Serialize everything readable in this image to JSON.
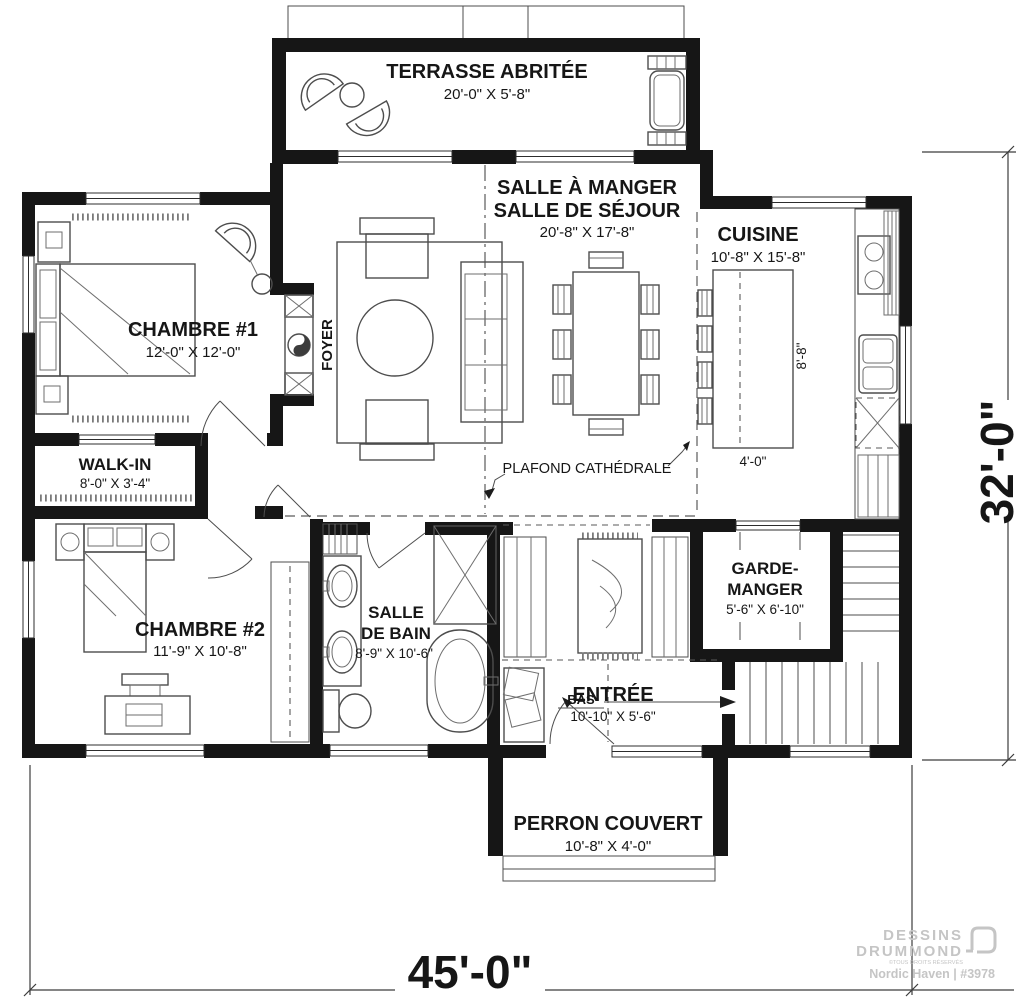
{
  "colors": {
    "wall": "#161616",
    "line": "#4d4d4d",
    "watermark": "#c5c5c5",
    "background": "#ffffff"
  },
  "rooms": {
    "terrasse": {
      "label": "TERRASSE ABRITÉE",
      "dims": "20'-0\" X 5'-8\""
    },
    "sejour": {
      "label1": "SALLE À MANGER",
      "label2": "SALLE DE SÉJOUR",
      "dims": "20'-8\" X 17'-8\""
    },
    "cuisine": {
      "label": "CUISINE",
      "dims": "10'-8\" X 15'-8\""
    },
    "chambre1": {
      "label": "CHAMBRE #1",
      "dims": "12'-0\" X 12'-0\""
    },
    "walkin": {
      "label": "WALK-IN",
      "dims": "8'-0\" X 3'-4\""
    },
    "chambre2": {
      "label": "CHAMBRE #2",
      "dims": "11'-9\" X 10'-8\""
    },
    "bain": {
      "label1": "SALLE",
      "label2": "DE BAIN",
      "dims": "8'-9\" X 10'-6\""
    },
    "entree": {
      "label": "ENTRÉE",
      "dims": "10'-10\" X 5'-6\""
    },
    "garde": {
      "label1": "GARDE-",
      "label2": "MANGER",
      "dims": "5'-6\" X 6'-10\""
    },
    "perron": {
      "label": "PERRON COUVERT",
      "dims": "10'-8\" X 4'-0\""
    }
  },
  "annotations": {
    "foyer": "FOYER",
    "plafond": "PLAFOND CATHÉDRALE",
    "bas": "BAS",
    "island_length": "8'-8\"",
    "island_width": "4'-0\""
  },
  "overall": {
    "width": "45'-0\"",
    "depth": "32'-0\""
  },
  "branding": {
    "brand1": "DESSINS",
    "brand2": "DRUMMOND",
    "rights": "©TOUS DROITS RÉSERVÉS",
    "plan": "Nordic Haven | #3978"
  }
}
